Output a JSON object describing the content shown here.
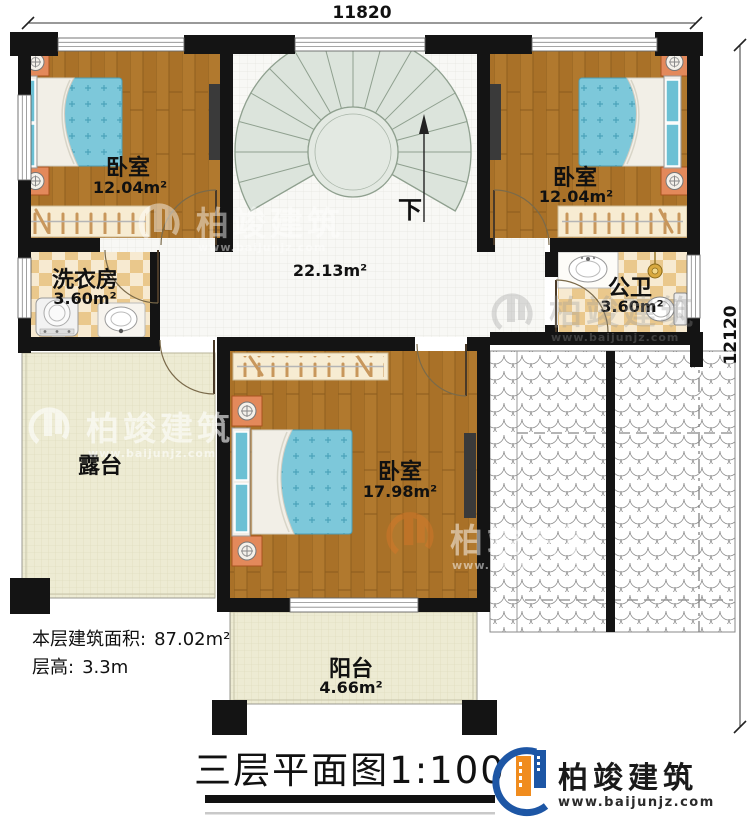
{
  "dimensions": {
    "top": "11820",
    "right": "12120"
  },
  "rooms": {
    "bedroom_left": {
      "name": "卧室",
      "area": "12.04m²"
    },
    "bedroom_right": {
      "name": "卧室",
      "area": "12.04m²"
    },
    "laundry": {
      "name": "洗衣房",
      "area": "3.60m²"
    },
    "bathroom": {
      "name": "公卫",
      "area": "3.60m²"
    },
    "hall": {
      "area": "22.13m²"
    },
    "bedroom_master": {
      "name": "卧室",
      "area": "17.98m²"
    },
    "terrace": {
      "name": "露台"
    },
    "balcony": {
      "name": "阳台",
      "area": "4.66m²"
    }
  },
  "stairs": {
    "direction_label": "下"
  },
  "info": {
    "floor_area_label": "本层建筑面积:",
    "floor_area_value": "87.02m²",
    "height_label": "层高:",
    "height_value": "3.3m"
  },
  "title": {
    "text": "三层平面图",
    "scale": "1:100"
  },
  "brand": {
    "name": "柏竣建筑",
    "website": "www.baijunjz.com"
  },
  "watermark": {
    "name": "柏竣建筑",
    "website": "www.baijunjz.com"
  },
  "colors": {
    "wall": "#141414",
    "wood": "#b1792e",
    "bed": "#7dc8da",
    "brand_blue": "#1d56a5",
    "brand_orange": "#f08c1e"
  }
}
